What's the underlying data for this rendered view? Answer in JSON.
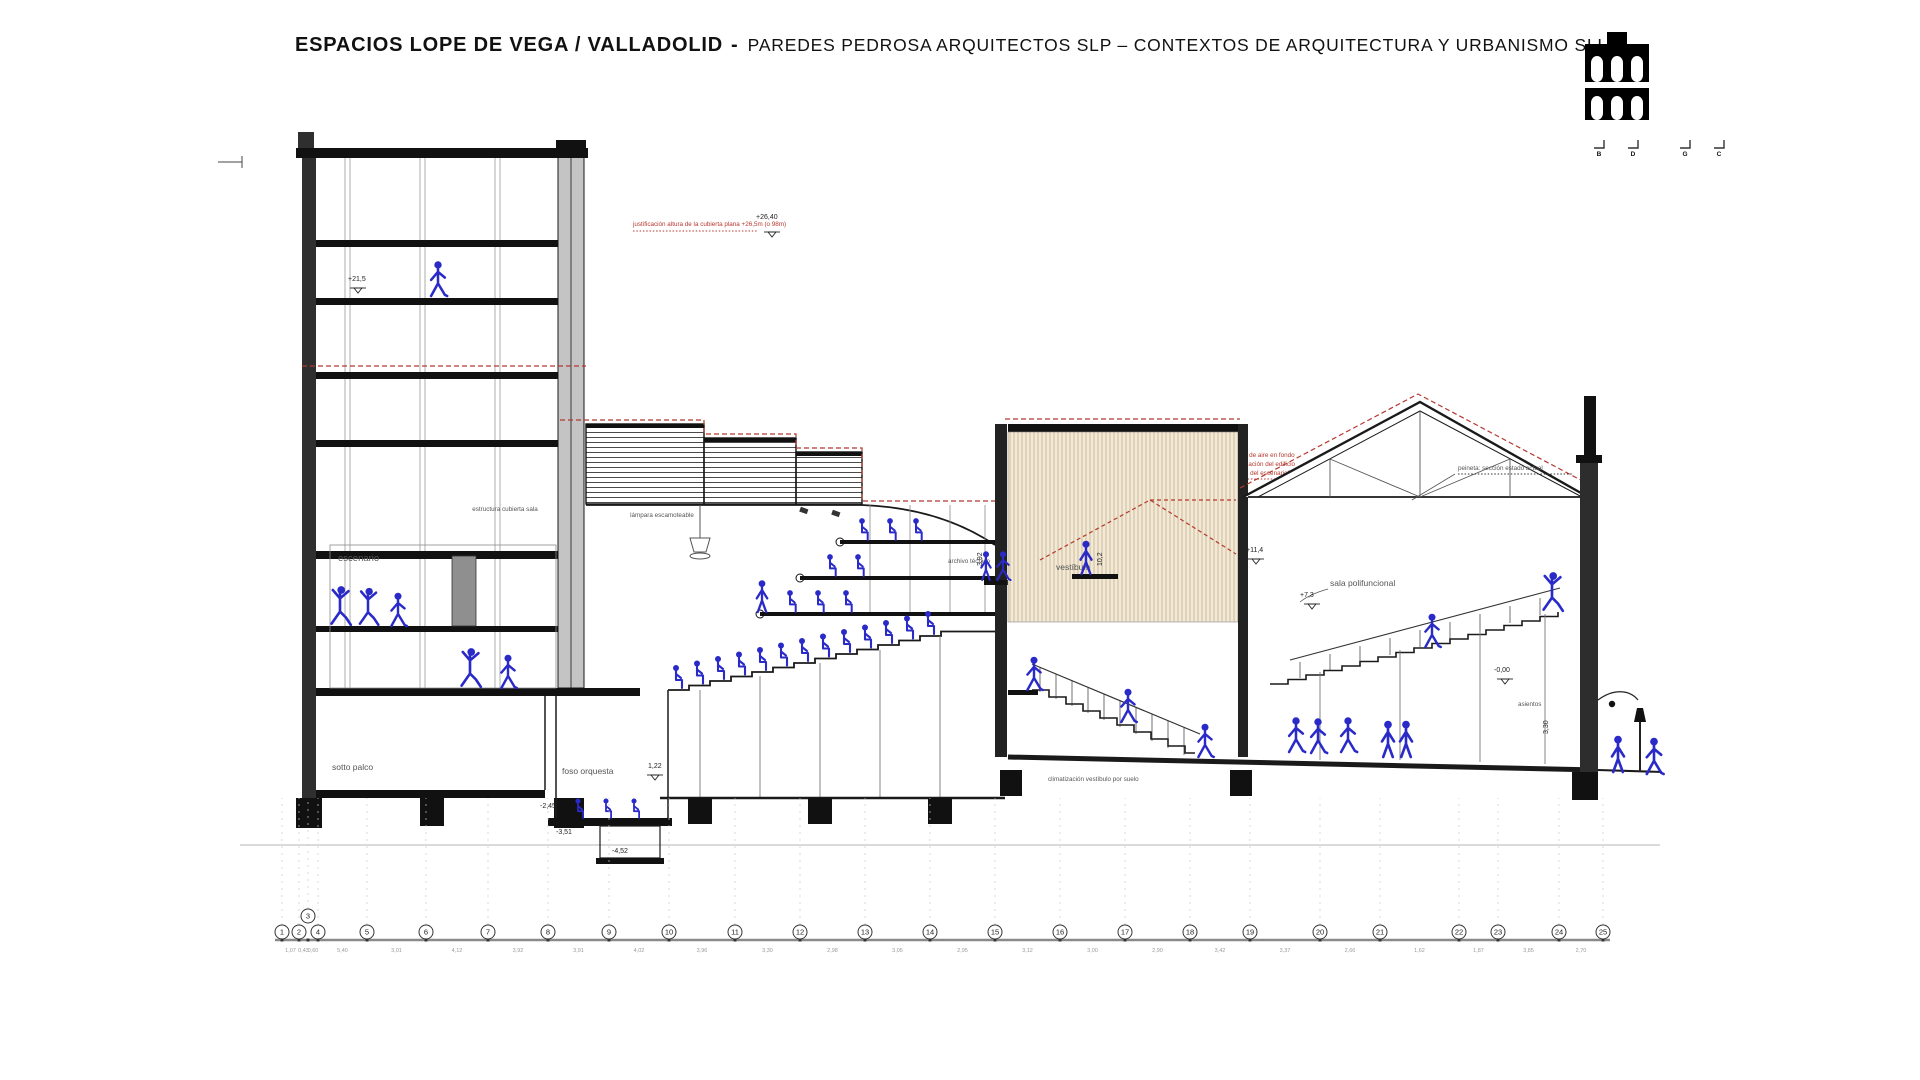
{
  "header": {
    "title_main": "ESPACIOS LOPE DE VEGA / VALLADOLID",
    "title_sep": "-",
    "title_sub": "PAREDES PEDROSA ARQUITECTOS SLP – CONTEXTOS DE ARQUITECTURA Y URBANISMO SLU"
  },
  "logo": {
    "name": "aqueduct-logo",
    "section_marks": [
      "B",
      "D",
      "G",
      "C"
    ]
  },
  "colors": {
    "figure_blue": "#2a2ac8",
    "annotation_red": "#b5382d",
    "beige_fill": "#f2e9d8",
    "beige_line": "#cdbb95",
    "wall_dark": "#2f2f2f",
    "wall_gray": "#c4c4c4",
    "ink": "#1a1a1a",
    "dim_gray": "#9a9a9a"
  },
  "drawing": {
    "labels": {
      "escenario": "escenario",
      "sotto_palco": "sotto palco",
      "foso_orquesta": "foso orquesta",
      "archivo_tecnico": "archivo técnico",
      "vestibulo": "vestíbulo",
      "sala_polifuncional": "sala polifuncional",
      "asientos": "asientos",
      "climatizacion": "climatización vestíbulo por suelo",
      "lampara": "lámpara escamoteable",
      "estructura": "estructura cubierta sala",
      "peineta_note": "peineta: sección estado actual",
      "roof_note": "justificación altura de la cubierta plana +26,5m (o 98m)"
    },
    "heritage_note": [
      "cotación inexacta altura del escenario de aire en fondo",
      "de las históricas en la ficha de catalogación del edificio",
      "8,61m. (±10m) desde la cota “de patio del escenario”"
    ],
    "elevations": {
      "e26": "+26,40",
      "e21": "+21,5",
      "e11": "+11,4",
      "e73": "+7,3",
      "e00": "-0,00",
      "em245": "-2,45",
      "em351": "-3,51",
      "em452": "-4,52",
      "d122": "1,22",
      "d392": "3,92",
      "d102": "10,2",
      "d330": "3,30"
    },
    "grid": {
      "bubbles": [
        "1",
        "2",
        "3",
        "4",
        "5",
        "6",
        "7",
        "8",
        "9",
        "10",
        "11",
        "12",
        "13",
        "14",
        "15",
        "16",
        "17",
        "18",
        "19",
        "20",
        "21",
        "22",
        "23",
        "24",
        "25"
      ],
      "positions": [
        282,
        299,
        308,
        318,
        367,
        426,
        488,
        548,
        609,
        669,
        735,
        800,
        865,
        930,
        995,
        1060,
        1125,
        1190,
        1250,
        1320,
        1380,
        1459,
        1498,
        1559,
        1603
      ],
      "dims": [
        "1,07",
        "0,43",
        "0,60",
        "5,40",
        "3,01",
        "4,12",
        "3,92",
        "3,91",
        "4,02",
        "3,96",
        "3,30",
        "2,98",
        "3,05",
        "2,95",
        "3,12",
        "3,00",
        "2,90",
        "3,42",
        "3,37",
        "2,66",
        "1,62",
        "1,87",
        "3,85",
        "2,70"
      ]
    }
  }
}
